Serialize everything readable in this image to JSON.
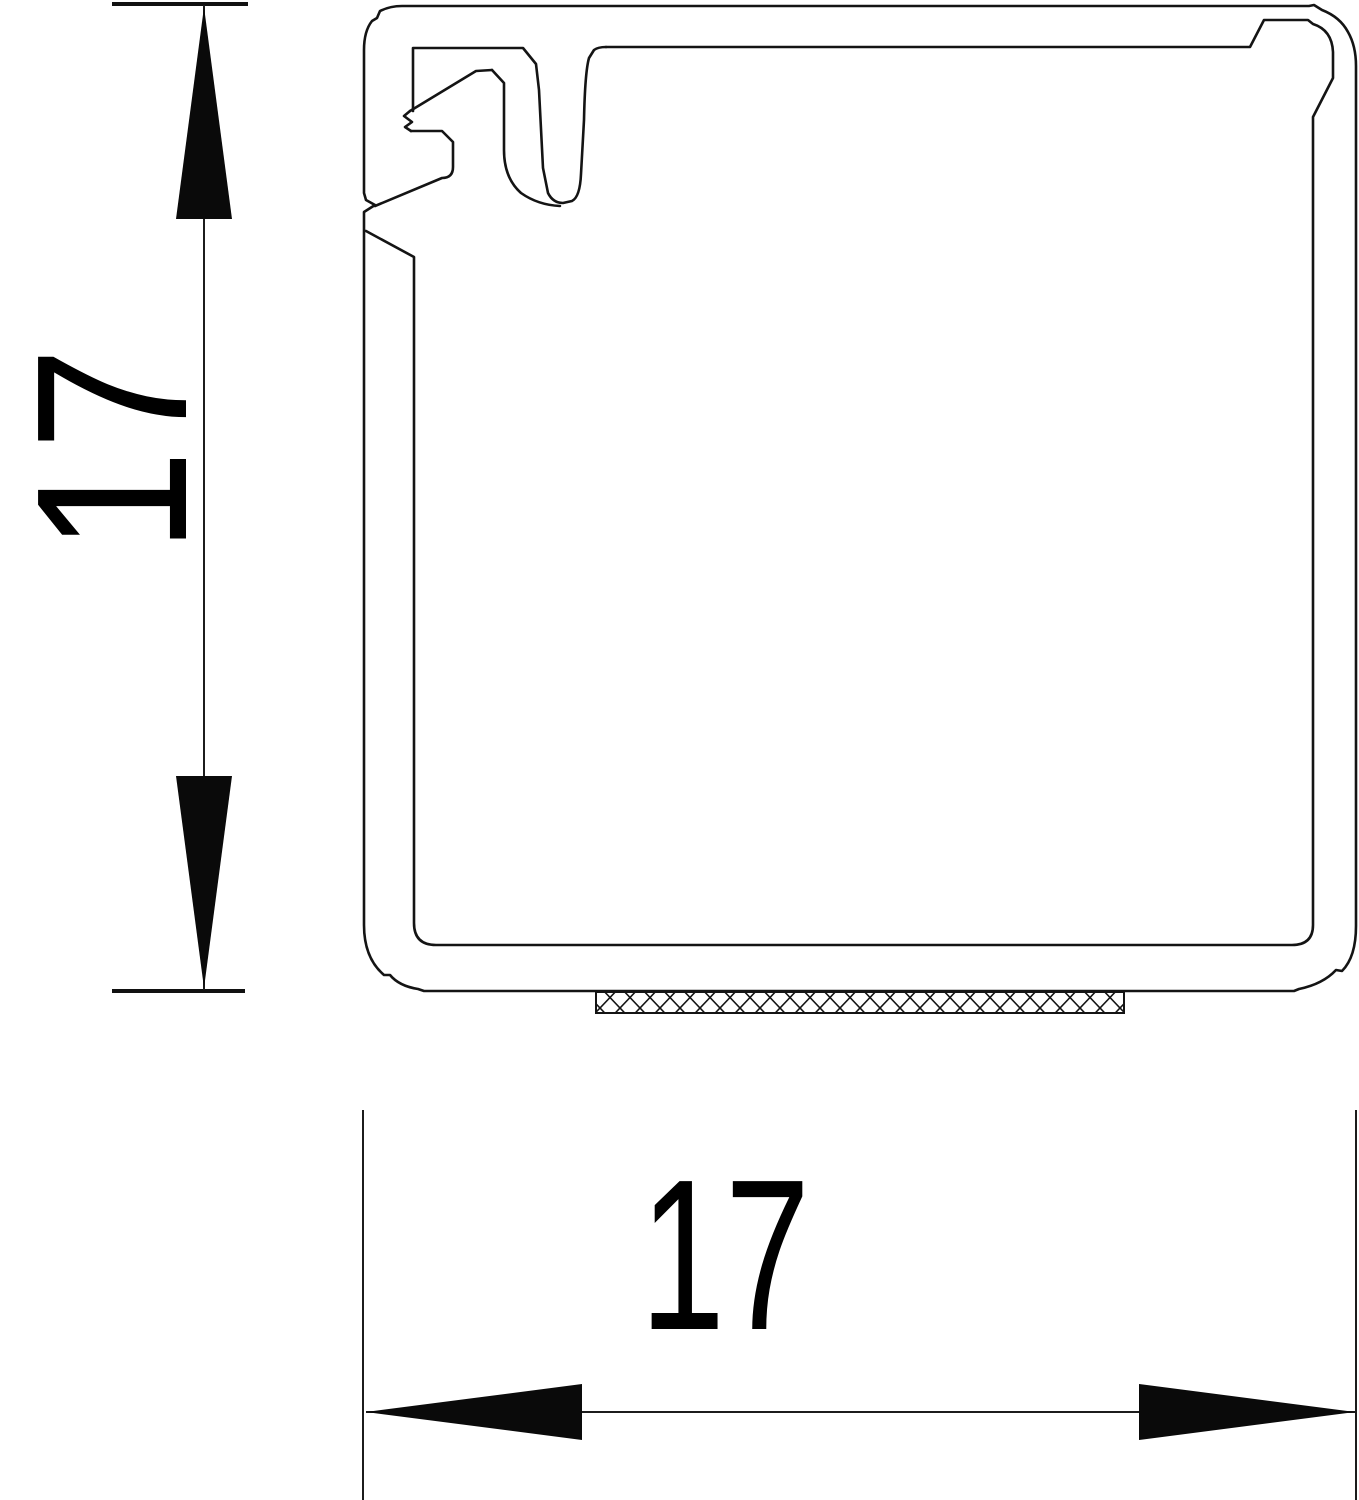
{
  "drawing": {
    "kind": "technical cross-section of square cable trunking with adhesive strip",
    "line_color": "#141414",
    "background_color": "#ffffff"
  },
  "dimensions": {
    "height": {
      "label": "17"
    },
    "width": {
      "label": "17"
    }
  }
}
